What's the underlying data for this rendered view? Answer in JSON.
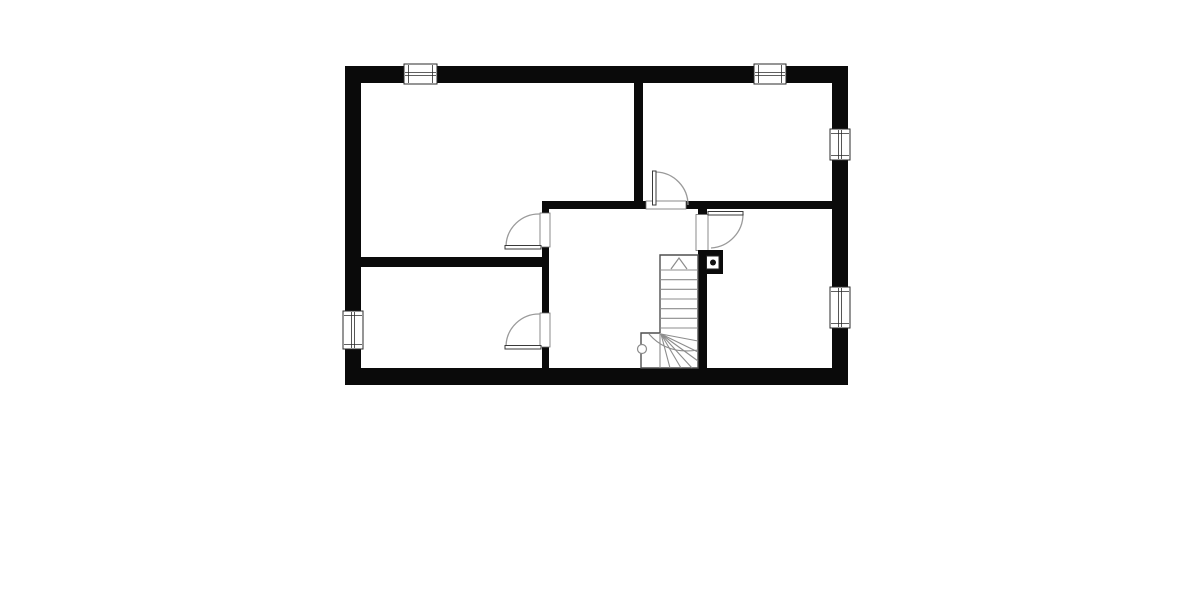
{
  "scene": {
    "width": 1200,
    "height": 600,
    "background": "#ffffff",
    "description": "architectural-floor-plan"
  },
  "palette": {
    "wall": "#0a0a0a",
    "white": "#ffffff",
    "window_frame": "#2b2b2b",
    "opening_frame": "#6e6e6e",
    "door_leaf": "#3a3a3a",
    "door_arc": "#9a9a9a",
    "stair_outline": "#4f4f4f",
    "stair_line": "#8c8c8c"
  },
  "walls": {
    "outer": [
      {
        "name": "outer-wall-top",
        "x": 345,
        "y": 66,
        "w": 503,
        "h": 17
      },
      {
        "name": "outer-wall-bottom",
        "x": 345,
        "y": 368,
        "w": 503,
        "h": 17
      },
      {
        "name": "outer-wall-left",
        "x": 345,
        "y": 66,
        "w": 16,
        "h": 319
      },
      {
        "name": "outer-wall-right",
        "x": 832,
        "y": 66,
        "w": 16,
        "h": 319
      }
    ],
    "interior": [
      {
        "name": "wall-top-rooms-divider",
        "x": 634,
        "y": 83,
        "w": 9,
        "h": 118
      },
      {
        "name": "wall-hall-top-left",
        "x": 542,
        "y": 201,
        "w": 104,
        "h": 8
      },
      {
        "name": "wall-hall-top-right",
        "x": 686,
        "y": 201,
        "w": 146,
        "h": 8
      },
      {
        "name": "wall-right-door-stub",
        "x": 698,
        "y": 201,
        "w": 9,
        "h": 14
      },
      {
        "name": "wall-hall-left-upper-stub",
        "x": 542,
        "y": 201,
        "w": 7,
        "h": 12
      },
      {
        "name": "wall-hall-left-mid",
        "x": 542,
        "y": 247,
        "w": 7,
        "h": 66
      },
      {
        "name": "wall-hall-left-lower-stub",
        "x": 542,
        "y": 347,
        "w": 7,
        "h": 21
      },
      {
        "name": "wall-left-rooms-divider",
        "x": 361,
        "y": 257,
        "w": 181,
        "h": 10
      },
      {
        "name": "wall-stairwell",
        "x": 698,
        "y": 250,
        "w": 9,
        "h": 118
      }
    ]
  },
  "windows": [
    {
      "name": "window-top-left",
      "x": 404,
      "y": 64,
      "w": 33,
      "h": 20,
      "orientation": "h"
    },
    {
      "name": "window-top-right",
      "x": 754,
      "y": 64,
      "w": 32,
      "h": 20,
      "orientation": "h"
    },
    {
      "name": "window-right-upper",
      "x": 830,
      "y": 129,
      "w": 20,
      "h": 31,
      "orientation": "v"
    },
    {
      "name": "window-right-lower",
      "x": 830,
      "y": 287,
      "w": 20,
      "h": 41,
      "orientation": "v"
    },
    {
      "name": "window-left",
      "x": 343,
      "y": 311,
      "w": 20,
      "h": 38,
      "orientation": "v"
    }
  ],
  "doors": [
    {
      "name": "door-top-right-room",
      "opening": {
        "x": 646,
        "y": 201,
        "w": 40,
        "h": 8
      },
      "leaf": {
        "x": 652.5,
        "y": 171,
        "w": 3.5,
        "h": 34
      },
      "arc": "M 656 172 A 33 33 0 0 1 688 205"
    },
    {
      "name": "door-bottom-right-room",
      "opening": {
        "x": 696,
        "y": 214.5,
        "w": 12,
        "h": 36
      },
      "leaf": {
        "x": 708,
        "y": 211.5,
        "w": 35,
        "h": 3.5
      },
      "arc": "M 743 214 A 34 34 0 0 1 711 248"
    },
    {
      "name": "door-top-left-room",
      "opening": {
        "x": 540,
        "y": 213,
        "w": 10,
        "h": 34
      },
      "leaf": {
        "x": 505,
        "y": 245.5,
        "w": 36,
        "h": 3.5
      },
      "arc": "M 506 246 A 33 33 0 0 1 540 214"
    },
    {
      "name": "door-bottom-left-room",
      "opening": {
        "x": 540,
        "y": 313,
        "w": 10,
        "h": 34
      },
      "leaf": {
        "x": 505,
        "y": 345.5,
        "w": 36,
        "h": 3.5
      },
      "arc": "M 506 346 A 33 33 0 0 1 540 314"
    }
  ],
  "chimney": {
    "name": "chimney-block",
    "outer": {
      "x": 698,
      "y": 250,
      "w": 25,
      "h": 24
    },
    "inner": {
      "x": 706.5,
      "y": 256,
      "w": 12.5,
      "h": 13
    },
    "dot": {
      "cx": 713,
      "cy": 262.5,
      "r": 3
    }
  },
  "stairs": {
    "name": "winder-staircase",
    "outline": "M 660 255 L 698 255 L 698 368 L 641 368 L 641 333 L 660 333 Z",
    "arrow": "M 671 269 L 679 258 L 687 269",
    "tread_x1": 660,
    "tread_x2": 698,
    "treads": [
      270,
      279.7,
      289.3,
      299,
      308.7,
      318.3,
      328
    ],
    "divider": "M 660 333 L 660 368",
    "fan": [
      "M 661 334 L 698 341",
      "M 661 334 L 698 352",
      "M 661 334 L 698 361",
      "M 661 334 L 692 368",
      "M 661 334 L 681 368",
      "M 661 334 L 670 368"
    ],
    "walkline": "M 649 334 Q 667 355 698 350",
    "newel": {
      "cx": 642,
      "cy": 349,
      "r": 4.5
    }
  }
}
